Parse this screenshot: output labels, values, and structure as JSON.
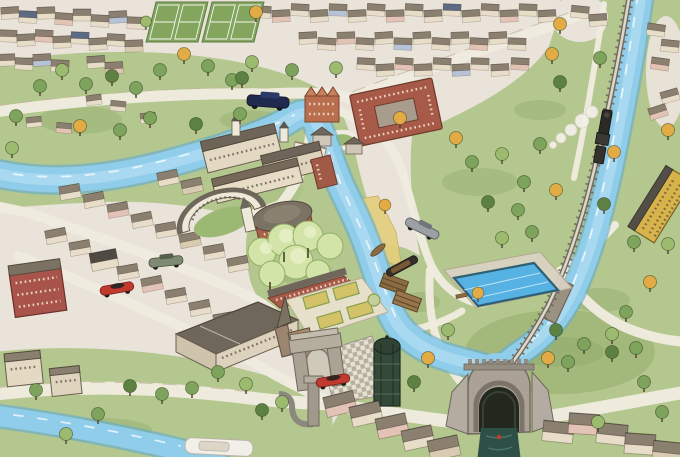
{
  "map": {
    "type": "illustrated-aerial-town-map",
    "features": [
      "tennis-courts",
      "suburban-housing",
      "riverside-park",
      "main-river",
      "northeast-river",
      "bottom-river",
      "road-bridge",
      "railway",
      "railway-bridge",
      "steam-train",
      "school-courtyard-building",
      "orange-gabled-house",
      "manor-complex",
      "royal-crescent",
      "domed-hall",
      "blossom-grove",
      "orangery",
      "formal-parterre-garden",
      "abbey-church",
      "brick-hotel",
      "town-houses",
      "sandy-riverbank",
      "canoe",
      "narrowboat",
      "canal-locks",
      "lido-pool",
      "pool-bench",
      "checkered-plaza",
      "memorial-arch",
      "glass-tower",
      "pump-chimney",
      "canal-tunnel-portal",
      "tunnel-boat",
      "riverside-mill",
      "terraced-houses",
      "riverside-cottages",
      "river-boat",
      "car-blue-vintage",
      "car-green-classic",
      "car-silver-classic",
      "car-red-sports-1",
      "car-red-sports-2",
      "trees-green",
      "trees-autumn",
      "village-green-oval"
    ]
  },
  "colors": {
    "paper": "#eae3da",
    "grass": "#b4c78e",
    "grassdark": "#85a160",
    "river": "#8fcdeb",
    "riveredge": "#69aecd",
    "riverlight": "#c2e5f5",
    "road": "#f0ebdf",
    "roadedge": "#c3b49c",
    "roofgray": "#7c7264",
    "roofdark": "#565046",
    "wallcream": "#e7ddc8",
    "brick": "#a85a48",
    "brickdark": "#6e3a2c",
    "millyellow": "#d8b34a",
    "tennis": "#84a55e",
    "pool": "#57b2e4",
    "towergreen": "#35493a",
    "stone": "#aba295",
    "stonedark": "#6f675c",
    "treegreen": "#7da35c",
    "treeyellow": "#e2ab45",
    "blossom": "#d3e4a8",
    "sand": "#e4cf7e",
    "carred": "#c23a2e",
    "carblue": "#20294e",
    "carsilver": "#9aa0a4",
    "cargreen": "#7e8b72",
    "trainblack": "#2c2a26",
    "waterdark": "#2e4f46",
    "smoke": "#f4f1ea"
  }
}
